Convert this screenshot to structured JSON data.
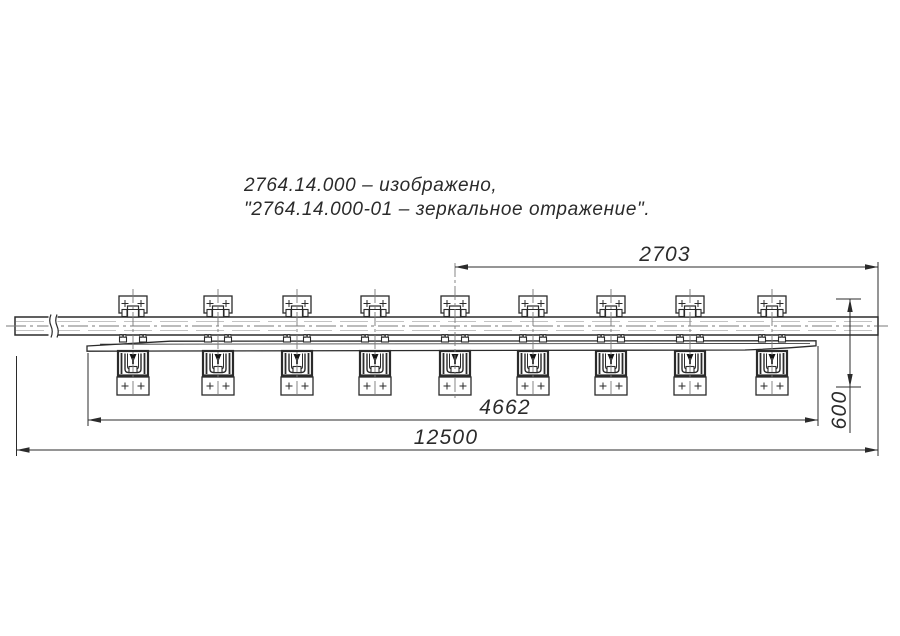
{
  "drawing": {
    "title_note": {
      "line1": "2764.14.000 – изображено,",
      "line2": "\"2764.14.000-01 – зеркальное отражение\"."
    },
    "dimensions": {
      "top_span": "2703",
      "guard_rail_span": "4662",
      "overall_length": "12500",
      "vertical_offset": "600"
    },
    "sleepers": {
      "count": 9,
      "x_centers": [
        133,
        218,
        297,
        375,
        455,
        533,
        611,
        690,
        772
      ]
    },
    "colors": {
      "line": "#2b2b2b",
      "light_line": "#c3c3c3",
      "centerline": "#7a7a7a",
      "background": "#ffffff"
    }
  }
}
